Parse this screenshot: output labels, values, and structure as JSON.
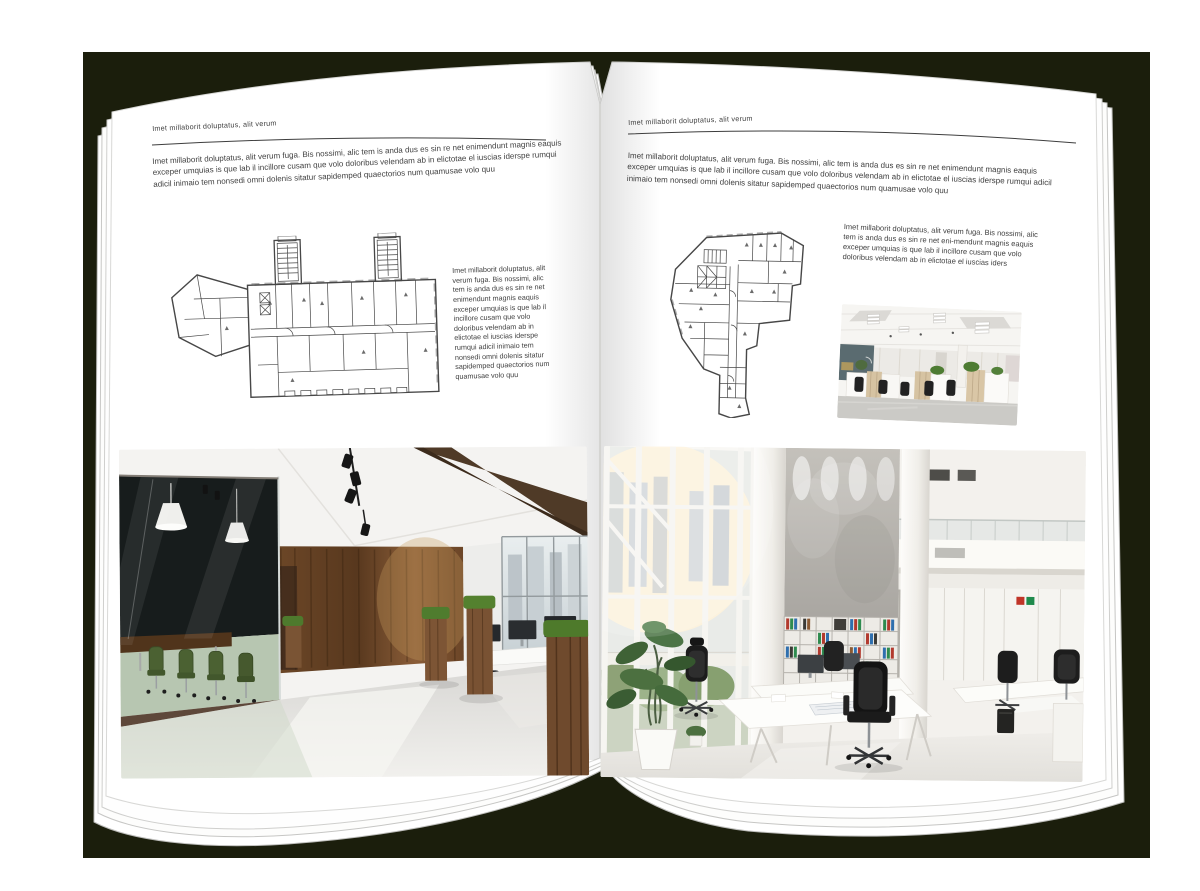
{
  "scene": {
    "backdrop_color": "#1b1e0c",
    "page_color": "#ffffff",
    "text_color": "#3f3f3f",
    "description": "Open magazine spread mockup on dark backdrop"
  },
  "left_page": {
    "kicker": "Imet millaborit doluptatus, alit verum",
    "intro": "Imet millaborit doluptatus, alit verum fuga. Bis nossimi, alic tem is anda dus es sin re net enimendunt magnis eaquis exceper umquias is que lab il incillore cusam que volo doloribus velendam ab in elictotae el iuscias iderspe rumqui adicil inimaio tem nonsedi omni dolenis sitatur sapidemped quaectorios num quamusae volo quu",
    "sidebar": "Imet millaborit doluptatus, alit verum fuga. Bis nossimi, alic tem is anda dus es sin re net enimendunt magnis eaquis exceper umquias is que lab il incillore cusam que volo doloribus velendam ab in elictotae el iuscias iderspe rumqui adicil inimaio tem nonsedi omni dolenis sitatur sapidemped quaectorios num quamusae volo quu"
  },
  "right_page": {
    "kicker": "Imet millaborit doluptatus, alit verum",
    "intro": "Imet millaborit doluptatus, alit verum fuga. Bis nossimi, alic tem is anda dus es sin re net enimendunt magnis eaquis exceper umquias is que lab il incillore cusam que volo doloribus velendam ab in elictotae el iuscias iderspe rumqui adicil inimaio tem nonsedi omni dolenis sitatur sapidemped quaectorios num quamusae volo quu",
    "sidebar": "Imet millaborit doluptatus, alit verum fuga. Bis nossimi, alic tem is anda dus es sin re net eni-mendunt magnis eaquis exceper umquias is que lab il incillore cusam que volo doloribus velendam ab in elictotae el iuscias iders"
  }
}
